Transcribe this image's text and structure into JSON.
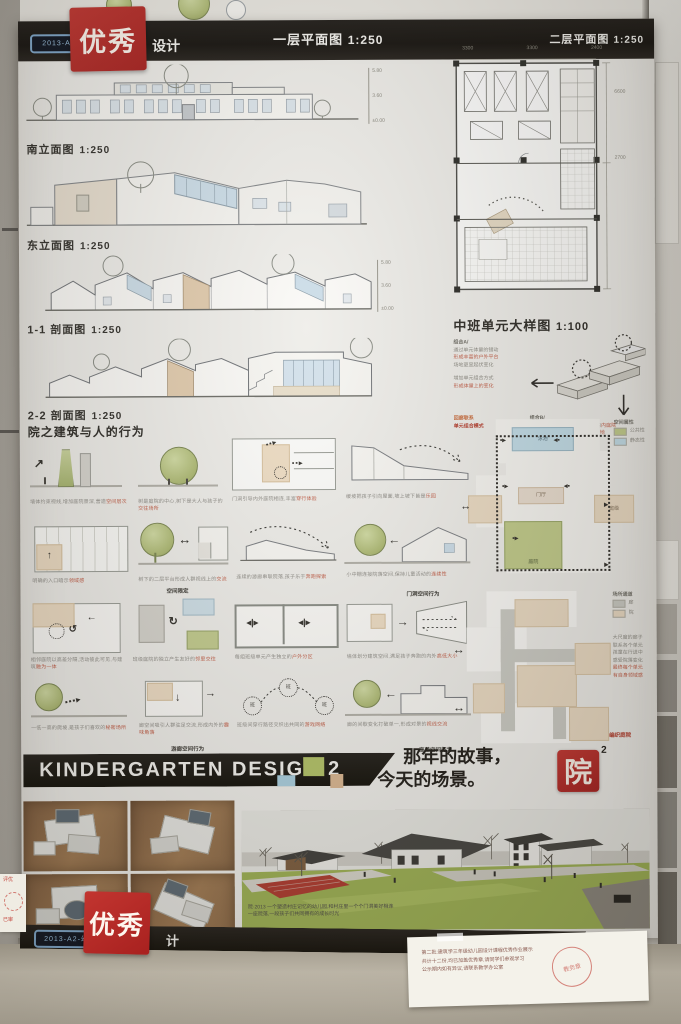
{
  "top_banner": {
    "sticker": "2013-A2-幼3",
    "stamp": "优秀",
    "suffix": "设计",
    "plan1": "一层平面图",
    "plan1_scale": "1:250",
    "plan2": "二层平面图",
    "plan2_scale": "1:250"
  },
  "drawings": {
    "d0": {
      "label": "南立面图",
      "scale": "1:250"
    },
    "d1": {
      "label": "东立面图",
      "scale": "1:250"
    },
    "d2": {
      "label": "1-1 剖面图",
      "scale": "1:250"
    },
    "d3": {
      "label": "2-2 剖面图",
      "scale": "1:250"
    }
  },
  "dims": {
    "levels": [
      "5.80",
      "3.60",
      "±0.00"
    ],
    "plan_top": [
      "3300",
      "3300",
      "2400"
    ],
    "plan_side": [
      "6600",
      "2700"
    ]
  },
  "unit_plan": {
    "label": "中班单元大样图",
    "scale": "1:100",
    "note_a_title": "组合A/",
    "note_a": [
      "通过单元体量的错动",
      "形成丰富的户外平台",
      "场地更显起伏变化"
    ],
    "note_a2": [
      "增加单元组合方式",
      "形成体量上的变化"
    ],
    "link1": "回廊联系",
    "link2": "单元组合模式",
    "note_b_title": "组合B/",
    "note_b": [
      "将每个小班单元错动,形成围合的",
      "内庭院",
      "为每个班级留出一块室外活动场地"
    ]
  },
  "behavior": {
    "title": "院之建筑与人的行为",
    "circle_label": "班",
    "cells": [
      {
        "text": "墙体约束视线,增加庭院景深,营造",
        "red": "空间层次"
      },
      {
        "text": "树是庭院的中心,树下是大人与孩子的",
        "red": "交往场所"
      },
      {
        "text": "门洞引导内外庭院相连,丰富",
        "red": "穿行体验"
      },
      {
        "text": "缓坡把孩子引向屋面,坡上坡下皆是",
        "red": "乐园"
      },
      {
        "text": "明确的入口暗示",
        "red": "领域感"
      },
      {
        "text": "树下的二层平台形成人群视线上的",
        "red": "交流"
      },
      {
        "text": "连续的游廊串联院落,孩子乐于",
        "red": "奔跑探索"
      },
      {
        "text": "小中棚连接院落空间,保持儿童活动的",
        "red": "连续性"
      },
      {
        "text": "相邻庭院以高差分隔,活动彼此可见,与建筑",
        "red": "融为一体"
      },
      {
        "text": "班级庭院的独立产生友好的",
        "red": "邻里交往"
      },
      {
        "text": "每组班级单元产生独立的",
        "red": "户外分区"
      },
      {
        "text": "墙体划分建筑空间,满足孩子奔跑的内外",
        "red": "高低大小"
      },
      {
        "text": "一低一高的爬坡,是孩子们喜欢的",
        "red": "秘密场所"
      },
      {
        "text": "廊空间吸引人群驻足交流,形成内外的",
        "red": "趣味角落"
      },
      {
        "text": "班级间穿行路径交织出共同的",
        "red": "游戏网络"
      },
      {
        "text": "廊的间歇变化打破单一,形成对景的",
        "red": "视线交流"
      }
    ],
    "tags": [
      "空间限定",
      "门洞空间行为",
      "游廊空间行为",
      "高差空间行为"
    ],
    "flow": {
      "pool": "泳池",
      "hall": "门厅",
      "class_unit": "班级",
      "court": "庭院",
      "legend_title": "空间属性",
      "legend": [
        {
          "label": "公共性"
        },
        {
          "label": "静态性"
        }
      ]
    },
    "site": {
      "legend_title": "场所通道",
      "legend": [
        {
          "label": "廊"
        },
        {
          "label": "院"
        }
      ],
      "notes": [
        "大尺度的廊子",
        "联系各个单元",
        "孩童在行进中",
        "感受院落变化",
        "最终每个单元",
        "有自身领域感"
      ],
      "tag": "编织庭院"
    }
  },
  "bottom_banner": {
    "title": "KINDERGARTEN DESIGN 2",
    "tagline1": "那年的故事，",
    "tagline2": "今天的场景。",
    "seal": "院",
    "seal_sup": "2"
  },
  "render_caption": {
    "line1": "院·2013 一个塑造村庄记忆的幼儿园,和村庄里一个个门洞美好相连",
    "line2": "一座院落,一段孩子们共同拥有的成长时光"
  },
  "next_poster_bar": {
    "sticker": "2013-A2-幼3",
    "stamp": "优秀",
    "suffix": "计"
  },
  "note_paper": {
    "lines": [
      "第二批:建筑学三年级幼儿园设计课程优秀作业展示",
      "共计十二份,均已加盖优秀章,请同学们参观学习",
      "公示期内如有异议,请联系教学办公室"
    ],
    "stamp": "教务章"
  },
  "small_note": {
    "line1": "评优",
    "line2": "已审"
  }
}
